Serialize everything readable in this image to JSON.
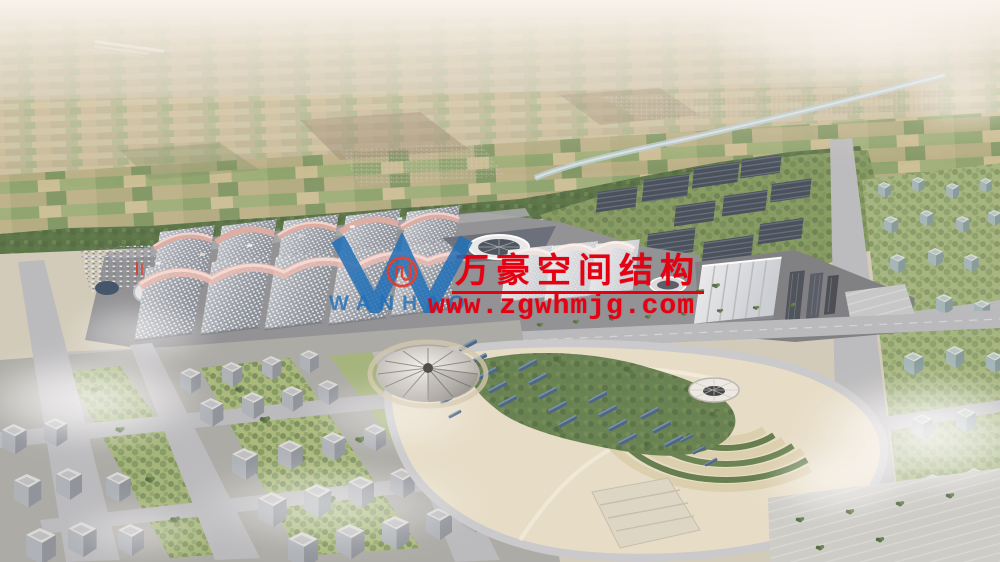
{
  "scene": {
    "type": "aerial-architectural-rendering",
    "subject": "exhibition center campus with ribbed vaulted halls, solar farm, landscaped park with tent pavilion, surrounding city blocks and farmland horizon"
  },
  "watermark": {
    "title": "万豪空间结构",
    "url": "www.zgwhmjg.com"
  },
  "logo": {
    "monogram": "W",
    "wordmark": "WANHAO"
  },
  "colors": {
    "wm_red": "#e60012",
    "logo_blue": "#2170b8",
    "logo_red": "#e03022",
    "ridge_pink": "#e0a79c",
    "roof_gray": "#9aa1ab",
    "solar_navy": "#3d4a5c",
    "park_sand": "#e6ddc6",
    "forest_green": "#5d7a44",
    "road_gray": "#b5b6ba"
  }
}
